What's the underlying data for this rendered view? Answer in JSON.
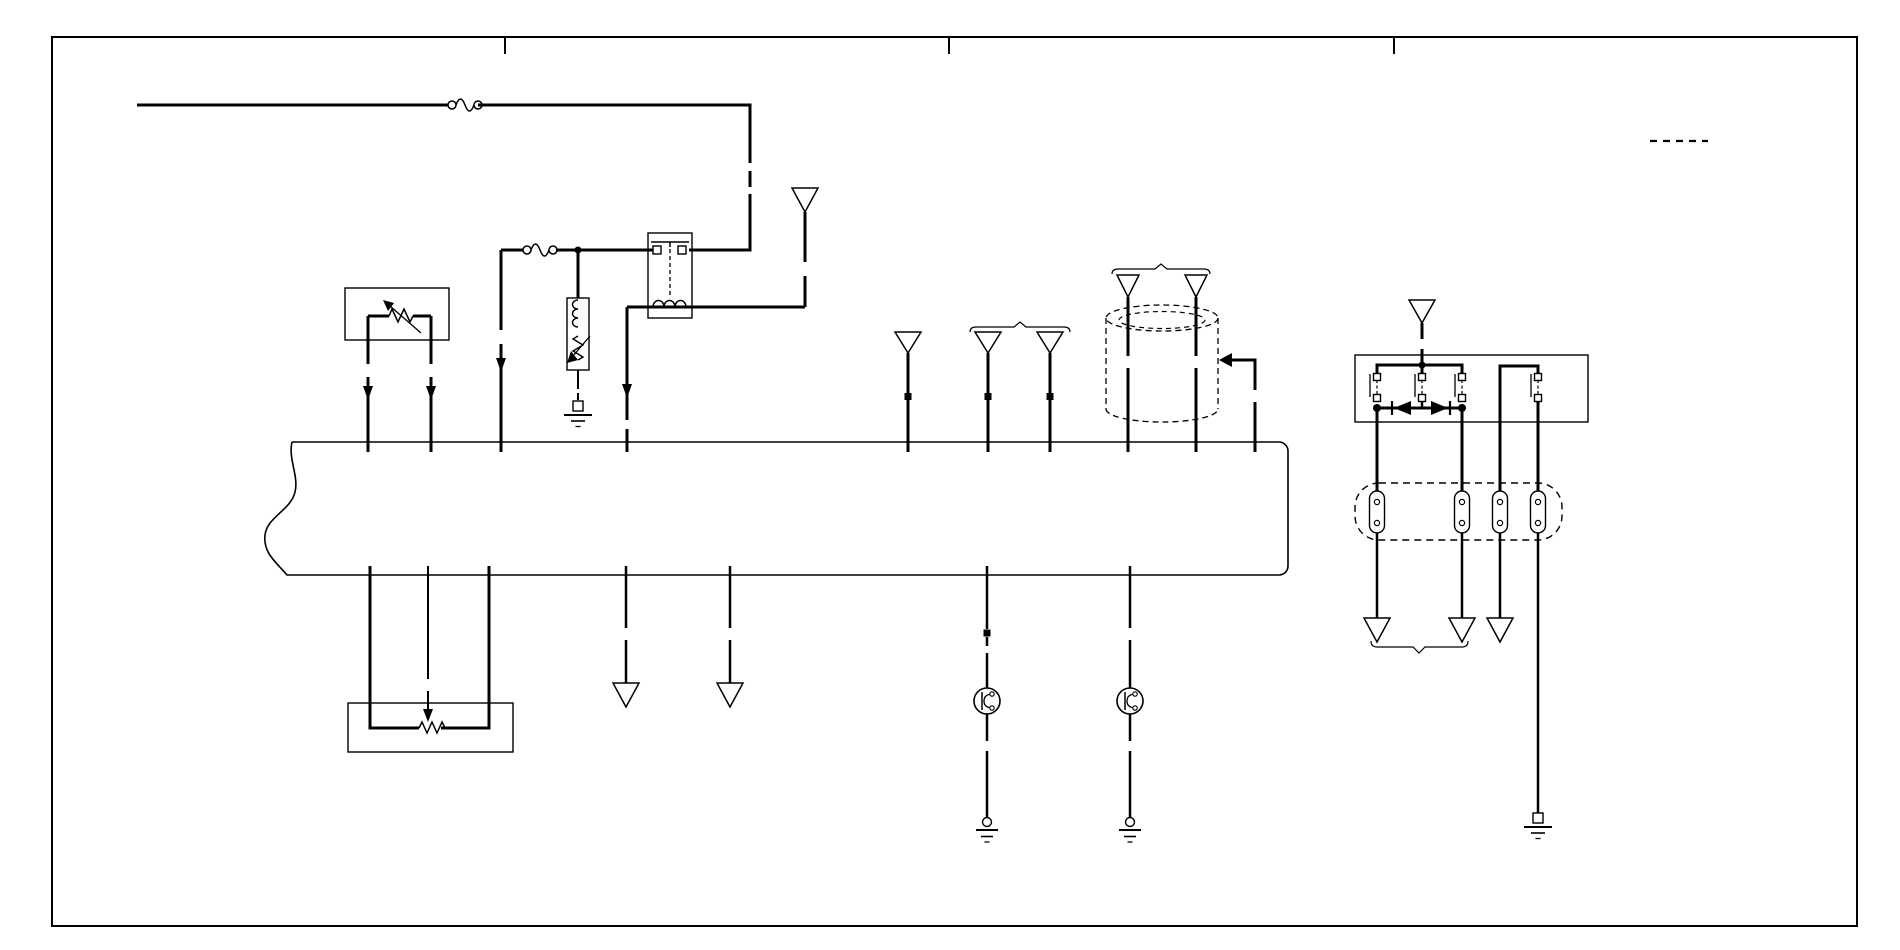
{
  "canvas": {
    "w": 1900,
    "h": 950,
    "ink": "#000000",
    "bg": "#ffffff"
  },
  "elements": [
    {
      "t": "rect",
      "n": "outer-border",
      "x": 52,
      "y": 37,
      "w": 1805,
      "h": 889,
      "sw": 2
    },
    {
      "t": "line",
      "n": "border-tick-1",
      "x1": 505,
      "y1": 38,
      "x2": 505,
      "y2": 54,
      "sw": 2
    },
    {
      "t": "line",
      "n": "border-tick-2",
      "x1": 949,
      "y1": 38,
      "x2": 949,
      "y2": 54,
      "sw": 2
    },
    {
      "t": "line",
      "n": "border-tick-3",
      "x1": 1394,
      "y1": 38,
      "x2": 1394,
      "y2": 54,
      "sw": 2
    },
    {
      "t": "line",
      "n": "legend-dashed-segment",
      "x1": 1650,
      "y1": 141,
      "x2": 1708,
      "y2": 141,
      "sw": 2.2,
      "dash": "7 6"
    },
    {
      "t": "path",
      "n": "main-harness-bus",
      "d": "M292,442 H1279 A9,9 0 0 1 1288,451 V566 A9,9 0 0 1 1279,575 H287 C276,562 263,553 265,535 C267,517 291,510 295,492 C299,476 288,459 292,442",
      "sw": 1.6
    },
    {
      "t": "rect",
      "n": "sensor-box",
      "x": 345,
      "y": 288,
      "w": 104,
      "h": 52,
      "sw": 1.4
    },
    {
      "t": "rect",
      "n": "relay-1-box",
      "x": 648,
      "y": 233,
      "w": 44,
      "h": 85,
      "sw": 1.4
    },
    {
      "t": "rect",
      "n": "solenoid-box",
      "x": 567,
      "y": 298,
      "w": 22,
      "h": 72,
      "sw": 1.4
    },
    {
      "t": "rect",
      "n": "relay-2-box",
      "x": 1355,
      "y": 355,
      "w": 233,
      "h": 67,
      "sw": 1.4
    },
    {
      "t": "rect",
      "n": "potentiometer-box",
      "x": 348,
      "y": 703,
      "w": 165,
      "h": 49,
      "sw": 1.4
    },
    {
      "t": "rect",
      "n": "connector-strip",
      "x": 1355,
      "y": 483,
      "w": 207,
      "h": 57,
      "rx": 24,
      "sw": 1.4,
      "dash": "7 5"
    },
    {
      "t": "line",
      "n": "feed-wire-1",
      "x1": 137,
      "y1": 105,
      "x2": 452,
      "y2": 105,
      "sw": 3
    },
    {
      "t": "fuse",
      "n": "fuse-1",
      "cx": 465,
      "cy": 105
    },
    {
      "t": "path",
      "n": "feed-wire-2",
      "d": "M478,105 H750 V163",
      "sw": 3
    },
    {
      "t": "line",
      "n": "feed-wire-2-break",
      "x1": 750,
      "y1": 171,
      "x2": 750,
      "y2": 187,
      "sw": 3
    },
    {
      "t": "path",
      "n": "feed-wire-3",
      "d": "M750,194 V250 H689",
      "sw": 3
    },
    {
      "t": "line",
      "n": "relay-1-contact-bar",
      "x1": 651,
      "y1": 242,
      "x2": 689,
      "y2": 242,
      "sw": 1.5
    },
    {
      "t": "line",
      "n": "relay-1-contact-tick",
      "x1": 670,
      "y1": 242,
      "x2": 670,
      "y2": 247,
      "sw": 1.5
    },
    {
      "t": "line",
      "n": "relay-1-link-dashed",
      "x1": 670,
      "y1": 249,
      "x2": 670,
      "y2": 296,
      "sw": 1.3,
      "dash": "4 3"
    },
    {
      "t": "line",
      "n": "relay-1-coil-wire",
      "x1": 627,
      "y1": 307,
      "x2": 805,
      "y2": 307,
      "sw": 3
    },
    {
      "t": "path",
      "n": "relay-1-coil",
      "d": "M653,307 a5.5,6.5 0 1 1 11,0 a5.5,6.5 0 1 1 11,0 a5.5,6.5 0 1 1 11,0",
      "sw": 1.5
    },
    {
      "t": "pin",
      "n": "relay-1-pin-left",
      "cx": 657,
      "cy": 250,
      "s": 8
    },
    {
      "t": "pin",
      "n": "relay-1-pin-right",
      "cx": 682,
      "cy": 250,
      "s": 8
    },
    {
      "t": "line",
      "n": "fused-feed-wire-1",
      "x1": 501,
      "y1": 250,
      "x2": 524,
      "y2": 250,
      "sw": 3
    },
    {
      "t": "fuse",
      "n": "fuse-2",
      "cx": 540,
      "cy": 250
    },
    {
      "t": "line",
      "n": "fused-feed-wire-2",
      "x1": 556,
      "y1": 250,
      "x2": 653,
      "y2": 250,
      "sw": 3
    },
    {
      "t": "circle",
      "n": "junction-dot-1",
      "cx": 578,
      "cy": 250,
      "r": 3.5,
      "f": "#000000"
    },
    {
      "t": "line",
      "n": "branch-down-wire-1",
      "x1": 501,
      "y1": 250,
      "x2": 501,
      "y2": 330,
      "sw": 3
    },
    {
      "t": "line",
      "n": "branch-down-wire-2",
      "x1": 501,
      "y1": 344,
      "x2": 501,
      "y2": 452,
      "sw": 3
    },
    {
      "t": "poly",
      "n": "flow-arrow-1",
      "p": "496,358 506,358 501,372",
      "f": "#000000"
    },
    {
      "t": "line",
      "n": "solenoid-feed-wire",
      "x1": 578,
      "y1": 250,
      "x2": 578,
      "y2": 298,
      "sw": 3
    },
    {
      "t": "path",
      "n": "solenoid-coil",
      "d": "M578,300 a5.5,4.5 0 1 0 0,9 a5.5,4.5 0 1 0 0,9 a5.5,4.5 0 1 0 0,9",
      "sw": 1.4
    },
    {
      "t": "path",
      "n": "solenoid-resistor",
      "d": "M578,336 l-5,3 l10,6 l-10,6 l10,6 l-5,3",
      "sw": 1.4
    },
    {
      "t": "line",
      "n": "solenoid-arrow-shaft",
      "x1": 590,
      "y1": 336,
      "x2": 573,
      "y2": 356,
      "sw": 1.3
    },
    {
      "t": "poly",
      "n": "solenoid-arrow-head",
      "p": "567,363 578,360 571,351",
      "f": "#000000"
    },
    {
      "t": "line",
      "n": "solenoid-ground-wire-1",
      "x1": 578,
      "y1": 370,
      "x2": 578,
      "y2": 389,
      "sw": 2
    },
    {
      "t": "line",
      "n": "solenoid-ground-wire-2",
      "x1": 578,
      "y1": 393,
      "x2": 578,
      "y2": 400,
      "sw": 2
    },
    {
      "t": "gndp",
      "n": "ground-symbol-1",
      "cx": 578,
      "y": 401
    },
    {
      "t": "line",
      "n": "relay-1-out-left-1",
      "x1": 627,
      "y1": 307,
      "x2": 627,
      "y2": 420,
      "sw": 3
    },
    {
      "t": "poly",
      "n": "flow-arrow-2",
      "p": "622,384 632,384 627,398",
      "f": "#000000"
    },
    {
      "t": "line",
      "n": "relay-1-out-left-2",
      "x1": 627,
      "y1": 429,
      "x2": 627,
      "y2": 452,
      "sw": 3
    },
    {
      "t": "line",
      "n": "relay-1-out-right-1",
      "x1": 805,
      "y1": 307,
      "x2": 805,
      "y2": 276,
      "sw": 3
    },
    {
      "t": "line",
      "n": "relay-1-out-right-2",
      "x1": 805,
      "y1": 262,
      "x2": 805,
      "y2": 212,
      "sw": 3
    },
    {
      "t": "poly",
      "n": "connector-arrow-1",
      "p": "792,188 818,188 805,212",
      "f": "#ffffff",
      "sw": 1.5
    },
    {
      "t": "line",
      "n": "sensor-wire-left",
      "x1": 368,
      "y1": 316,
      "x2": 389,
      "y2": 316,
      "sw": 3
    },
    {
      "t": "path",
      "n": "sensor-resistor",
      "d": "M389,316 l3,-7 l6,13 l6,-13 l6,13 l3,-6",
      "sw": 1.5
    },
    {
      "t": "line",
      "n": "sensor-wire-right",
      "x1": 413,
      "y1": 316,
      "x2": 431,
      "y2": 316,
      "sw": 3
    },
    {
      "t": "line",
      "n": "sensor-arrow-shaft",
      "x1": 421,
      "y1": 333,
      "x2": 390,
      "y2": 306,
      "sw": 1.3
    },
    {
      "t": "poly",
      "n": "sensor-arrow-head",
      "p": "383,300 394,303 388,311",
      "f": "#000000"
    },
    {
      "t": "line",
      "n": "sensor-leg-left-1",
      "x1": 368,
      "y1": 316,
      "x2": 368,
      "y2": 364,
      "sw": 3
    },
    {
      "t": "line",
      "n": "sensor-leg-left-2",
      "x1": 368,
      "y1": 377,
      "x2": 368,
      "y2": 452,
      "sw": 3
    },
    {
      "t": "poly",
      "n": "flow-arrow-3",
      "p": "363,386 373,386 368,400",
      "f": "#000000"
    },
    {
      "t": "line",
      "n": "sensor-leg-right-1",
      "x1": 431,
      "y1": 316,
      "x2": 431,
      "y2": 364,
      "sw": 3
    },
    {
      "t": "line",
      "n": "sensor-leg-right-2",
      "x1": 431,
      "y1": 377,
      "x2": 431,
      "y2": 452,
      "sw": 3
    },
    {
      "t": "poly",
      "n": "flow-arrow-4",
      "p": "426,386 436,386 431,400",
      "f": "#000000"
    },
    {
      "t": "line",
      "n": "branch-wire-a",
      "x1": 908,
      "y1": 353,
      "x2": 908,
      "y2": 452,
      "sw": 3
    },
    {
      "t": "poly",
      "n": "connector-arrow-2",
      "p": "895,332 921,332 908,353",
      "f": "#ffffff",
      "sw": 1.5
    },
    {
      "t": "rect",
      "n": "splice-marker-a",
      "x": 904.5,
      "y": 393,
      "w": 7,
      "h": 7,
      "f": "#000000"
    },
    {
      "t": "path",
      "n": "pair-bracket-1",
      "d": "M970,332 Q970,327 976,327 H1014 L1020,322 L1026,327 H1064 Q1070,327 1070,332",
      "sw": 1.2
    },
    {
      "t": "line",
      "n": "branch-wire-b",
      "x1": 988,
      "y1": 353,
      "x2": 988,
      "y2": 452,
      "sw": 3
    },
    {
      "t": "poly",
      "n": "connector-arrow-3",
      "p": "975,332 1001,332 988,353",
      "f": "#ffffff",
      "sw": 1.5
    },
    {
      "t": "rect",
      "n": "splice-marker-b",
      "x": 984.5,
      "y": 393,
      "w": 7,
      "h": 7,
      "f": "#000000"
    },
    {
      "t": "line",
      "n": "branch-wire-c",
      "x1": 1050,
      "y1": 353,
      "x2": 1050,
      "y2": 452,
      "sw": 3
    },
    {
      "t": "poly",
      "n": "connector-arrow-4",
      "p": "1037,332 1063,332 1050,353",
      "f": "#ffffff",
      "sw": 1.5
    },
    {
      "t": "rect",
      "n": "splice-marker-c",
      "x": 1046.5,
      "y": 393,
      "w": 7,
      "h": 7,
      "f": "#000000"
    },
    {
      "t": "path",
      "n": "pair-bracket-2",
      "d": "M1112,274 Q1112,269 1118,269 H1155 L1161,264 L1167,269 H1204 Q1210,269 1210,274",
      "sw": 1.2
    },
    {
      "t": "poly",
      "n": "connector-arrow-5",
      "p": "1117,275 1139,275 1128,297",
      "f": "#ffffff",
      "sw": 1.5
    },
    {
      "t": "poly",
      "n": "connector-arrow-6",
      "p": "1185,275 1207,275 1196,297",
      "f": "#ffffff",
      "sw": 1.5
    },
    {
      "t": "line",
      "n": "cylinder-wire-left-1",
      "x1": 1128,
      "y1": 297,
      "x2": 1128,
      "y2": 356,
      "sw": 3
    },
    {
      "t": "line",
      "n": "cylinder-wire-left-2",
      "x1": 1128,
      "y1": 368,
      "x2": 1128,
      "y2": 452,
      "sw": 3
    },
    {
      "t": "line",
      "n": "cylinder-wire-right-1",
      "x1": 1196,
      "y1": 297,
      "x2": 1196,
      "y2": 356,
      "sw": 3
    },
    {
      "t": "line",
      "n": "cylinder-wire-right-2",
      "x1": 1196,
      "y1": 368,
      "x2": 1196,
      "y2": 452,
      "sw": 3
    },
    {
      "t": "ellipse",
      "n": "cylinder-top-rim",
      "cx": 1162,
      "cy": 318,
      "rx": 56,
      "ry": 13,
      "sw": 1.3,
      "dash": "6 4"
    },
    {
      "t": "ellipse",
      "n": "cylinder-top-rim-inner",
      "cx": 1162,
      "cy": 320,
      "rx": 43,
      "ry": 8.5,
      "sw": 1.2,
      "dash": "5 4"
    },
    {
      "t": "line",
      "n": "cylinder-side-left",
      "x1": 1106,
      "y1": 318,
      "x2": 1106,
      "y2": 409,
      "sw": 1.3,
      "dash": "6 4"
    },
    {
      "t": "line",
      "n": "cylinder-side-right",
      "x1": 1218,
      "y1": 318,
      "x2": 1218,
      "y2": 409,
      "sw": 1.3,
      "dash": "6 4"
    },
    {
      "t": "path",
      "n": "cylinder-bottom-rim",
      "d": "M1106,409 A56,13 0 0 0 1218,409",
      "sw": 1.3,
      "dash": "6 4"
    },
    {
      "t": "poly",
      "n": "tap-arrow-head",
      "p": "1219,360 1232,353 1232,367",
      "f": "#000000"
    },
    {
      "t": "path",
      "n": "tap-wire-1",
      "d": "M1231,360 H1255 V390",
      "sw": 3
    },
    {
      "t": "line",
      "n": "tap-wire-2",
      "x1": 1255,
      "y1": 402,
      "x2": 1255,
      "y2": 452,
      "sw": 3
    },
    {
      "t": "poly",
      "n": "connector-arrow-7",
      "p": "1409,300 1435,300 1422,323",
      "f": "#ffffff",
      "sw": 1.5
    },
    {
      "t": "line",
      "n": "relay-2-feed-1",
      "x1": 1422,
      "y1": 323,
      "x2": 1422,
      "y2": 339,
      "sw": 3
    },
    {
      "t": "line",
      "n": "relay-2-feed-2",
      "x1": 1422,
      "y1": 349,
      "x2": 1422,
      "y2": 365,
      "sw": 3
    },
    {
      "t": "path",
      "n": "relay-2-top-bus",
      "d": "M1377,373 V365 H1462 V373",
      "sw": 3
    },
    {
      "t": "line",
      "n": "relay-2-top-bus-tick",
      "x1": 1422,
      "y1": 365,
      "x2": 1422,
      "y2": 374,
      "sw": 3
    },
    {
      "t": "circle",
      "n": "junction-dot-2",
      "cx": 1422,
      "cy": 365,
      "r": 3.5,
      "f": "#000000"
    },
    {
      "t": "contact",
      "n": "relay-2-contact-1",
      "cx": 1377
    },
    {
      "t": "contact",
      "n": "relay-2-contact-2",
      "cx": 1422
    },
    {
      "t": "contact",
      "n": "relay-2-contact-3",
      "cx": 1462
    },
    {
      "t": "contact",
      "n": "relay-2-contact-4",
      "cx": 1538
    },
    {
      "t": "line",
      "n": "relay-2-diode-bus",
      "x1": 1377,
      "y1": 408,
      "x2": 1462,
      "y2": 408,
      "sw": 3
    },
    {
      "t": "line",
      "n": "relay-2-mid-link",
      "x1": 1422,
      "y1": 401,
      "x2": 1422,
      "y2": 408,
      "sw": 2.5
    },
    {
      "t": "circle",
      "n": "junction-dot-3",
      "cx": 1377,
      "cy": 408,
      "r": 4,
      "f": "#000000"
    },
    {
      "t": "circle",
      "n": "junction-dot-4",
      "cx": 1462,
      "cy": 408,
      "r": 4,
      "f": "#000000"
    },
    {
      "t": "poly",
      "n": "diode-left",
      "p": "1394,408 1411,401 1411,415",
      "f": "#000000"
    },
    {
      "t": "line",
      "n": "diode-left-bar",
      "x1": 1392,
      "y1": 401,
      "x2": 1392,
      "y2": 415,
      "sw": 2.2
    },
    {
      "t": "poly",
      "n": "diode-right",
      "p": "1448,408 1431,401 1431,415",
      "f": "#000000"
    },
    {
      "t": "line",
      "n": "diode-right-bar",
      "x1": 1450,
      "y1": 401,
      "x2": 1450,
      "y2": 415,
      "sw": 2.2
    },
    {
      "t": "path",
      "n": "relay-2-right-bus",
      "d": "M1538,373 V366 H1500 V492",
      "sw": 3
    },
    {
      "t": "line",
      "n": "relay-2-out-1",
      "x1": 1377,
      "y1": 408,
      "x2": 1377,
      "y2": 492,
      "sw": 3
    },
    {
      "t": "line",
      "n": "relay-2-out-2",
      "x1": 1462,
      "y1": 408,
      "x2": 1462,
      "y2": 492,
      "sw": 3
    },
    {
      "t": "line",
      "n": "relay-2-out-4",
      "x1": 1538,
      "y1": 401,
      "x2": 1538,
      "y2": 492,
      "sw": 3
    },
    {
      "t": "stadium",
      "n": "strip-terminal-1",
      "cx": 1377,
      "cy": 512
    },
    {
      "t": "stadium",
      "n": "strip-terminal-2",
      "cx": 1462,
      "cy": 512
    },
    {
      "t": "stadium",
      "n": "strip-terminal-3",
      "cx": 1500,
      "cy": 512
    },
    {
      "t": "stadium",
      "n": "strip-terminal-4",
      "cx": 1538,
      "cy": 512
    },
    {
      "t": "line",
      "n": "out-wire-1",
      "x1": 1377,
      "y1": 533,
      "x2": 1377,
      "y2": 618,
      "sw": 2.5
    },
    {
      "t": "poly",
      "n": "connector-arrow-8",
      "p": "1364,618 1390,618 1377,642",
      "f": "#ffffff",
      "sw": 1.5
    },
    {
      "t": "line",
      "n": "out-wire-2",
      "x1": 1462,
      "y1": 533,
      "x2": 1462,
      "y2": 618,
      "sw": 2.5
    },
    {
      "t": "poly",
      "n": "connector-arrow-9",
      "p": "1449,618 1475,618 1462,642",
      "f": "#ffffff",
      "sw": 1.5
    },
    {
      "t": "line",
      "n": "out-wire-3",
      "x1": 1500,
      "y1": 533,
      "x2": 1500,
      "y2": 618,
      "sw": 2.5
    },
    {
      "t": "poly",
      "n": "connector-arrow-10",
      "p": "1487,618 1513,618 1500,642",
      "f": "#ffffff",
      "sw": 1.5
    },
    {
      "t": "path",
      "n": "pair-underbrace",
      "d": "M1371,641 Q1371,647 1377,647 H1413 L1419,653 L1425,647 H1462 Q1468,647 1468,641",
      "sw": 1.2
    },
    {
      "t": "line",
      "n": "ground-wire-right",
      "x1": 1538,
      "y1": 533,
      "x2": 1538,
      "y2": 813,
      "sw": 2.5
    },
    {
      "t": "gndp",
      "n": "ground-symbol-4",
      "cx": 1538,
      "y": 813
    },
    {
      "t": "line",
      "n": "driver-1-wire-1",
      "x1": 987,
      "y1": 566,
      "x2": 987,
      "y2": 629,
      "sw": 2.5
    },
    {
      "t": "rect",
      "n": "splice-marker-d",
      "x": 983.5,
      "y": 629.5,
      "w": 7,
      "h": 7,
      "f": "#000000"
    },
    {
      "t": "line",
      "n": "driver-1-wire-2",
      "x1": 987,
      "y1": 637,
      "x2": 987,
      "y2": 646,
      "sw": 2.5
    },
    {
      "t": "line",
      "n": "driver-1-wire-3",
      "x1": 987,
      "y1": 653,
      "x2": 987,
      "y2": 688,
      "sw": 2.5
    },
    {
      "t": "transistor",
      "n": "driver-device-1",
      "cx": 987,
      "cy": 701
    },
    {
      "t": "line",
      "n": "driver-1-wire-4",
      "x1": 987,
      "y1": 714,
      "x2": 987,
      "y2": 741,
      "sw": 2.5
    },
    {
      "t": "line",
      "n": "driver-1-wire-5",
      "x1": 987,
      "y1": 751,
      "x2": 987,
      "y2": 818,
      "sw": 2.5
    },
    {
      "t": "gndc",
      "n": "ground-symbol-2",
      "cx": 987
    },
    {
      "t": "line",
      "n": "driver-2-wire-1",
      "x1": 1130,
      "y1": 566,
      "x2": 1130,
      "y2": 628,
      "sw": 2.5
    },
    {
      "t": "line",
      "n": "driver-2-wire-2",
      "x1": 1130,
      "y1": 640,
      "x2": 1130,
      "y2": 688,
      "sw": 2.5
    },
    {
      "t": "transistor",
      "n": "driver-device-2",
      "cx": 1130,
      "cy": 701
    },
    {
      "t": "line",
      "n": "driver-2-wire-3",
      "x1": 1130,
      "y1": 714,
      "x2": 1130,
      "y2": 741,
      "sw": 2.5
    },
    {
      "t": "line",
      "n": "driver-2-wire-4",
      "x1": 1130,
      "y1": 751,
      "x2": 1130,
      "y2": 818,
      "sw": 2.5
    },
    {
      "t": "gndc",
      "n": "ground-symbol-3",
      "cx": 1130
    },
    {
      "t": "line",
      "n": "out-wire-4",
      "x1": 626,
      "y1": 566,
      "x2": 626,
      "y2": 628,
      "sw": 2.5
    },
    {
      "t": "line",
      "n": "out-wire-5",
      "x1": 626,
      "y1": 640,
      "x2": 626,
      "y2": 683,
      "sw": 2.5
    },
    {
      "t": "poly",
      "n": "connector-arrow-11",
      "p": "613,683 639,683 626,707",
      "f": "#ffffff",
      "sw": 1.5
    },
    {
      "t": "line",
      "n": "out-wire-6",
      "x1": 730,
      "y1": 566,
      "x2": 730,
      "y2": 628,
      "sw": 2.5
    },
    {
      "t": "line",
      "n": "out-wire-7",
      "x1": 730,
      "y1": 640,
      "x2": 730,
      "y2": 683,
      "sw": 2.5
    },
    {
      "t": "poly",
      "n": "connector-arrow-12",
      "p": "717,683 743,683 730,707",
      "f": "#ffffff",
      "sw": 1.5
    },
    {
      "t": "path",
      "n": "pot-wire-left",
      "d": "M370,566 V728 H419",
      "sw": 3
    },
    {
      "t": "path",
      "n": "pot-resistor",
      "d": "M419,728 l3,-6 l5,11 l5,-11 l5,11 l5,-11 l3,6",
      "sw": 1.5
    },
    {
      "t": "path",
      "n": "pot-wire-right",
      "d": "M441,728 H489 V566",
      "sw": 3
    },
    {
      "t": "line",
      "n": "pot-wiper-wire-1",
      "x1": 428,
      "y1": 566,
      "x2": 428,
      "y2": 679,
      "sw": 2
    },
    {
      "t": "line",
      "n": "pot-wiper-wire-2",
      "x1": 428,
      "y1": 691,
      "x2": 428,
      "y2": 709,
      "sw": 2
    },
    {
      "t": "poly",
      "n": "pot-wiper-arrow",
      "p": "423,709 433,709 428,722",
      "f": "#000000"
    }
  ]
}
